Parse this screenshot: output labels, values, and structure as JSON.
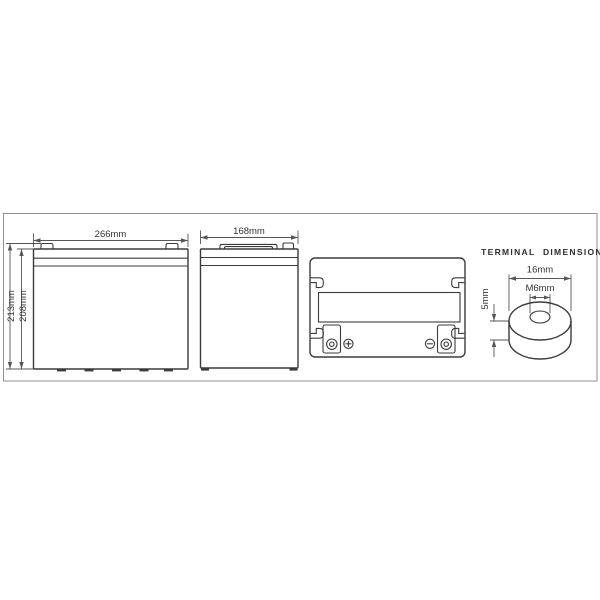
{
  "drawing": {
    "title": "TERMINAL DIMENSION",
    "front_view": {
      "width": "266mm",
      "overall_height": "213mm",
      "case_height": "208mm"
    },
    "side_view": {
      "depth": "168mm"
    },
    "terminal_detail": {
      "outer_diameter": "16mm",
      "thread": "M6mm",
      "thickness": "5mm"
    },
    "icons": {
      "positive_terminal": "plus-circle",
      "negative_terminal": "minus-circle"
    },
    "colors": {
      "line": "#3b3b3b",
      "dimension": "#565656",
      "frame": "#8f8f8f",
      "background": "#ffffff"
    }
  }
}
